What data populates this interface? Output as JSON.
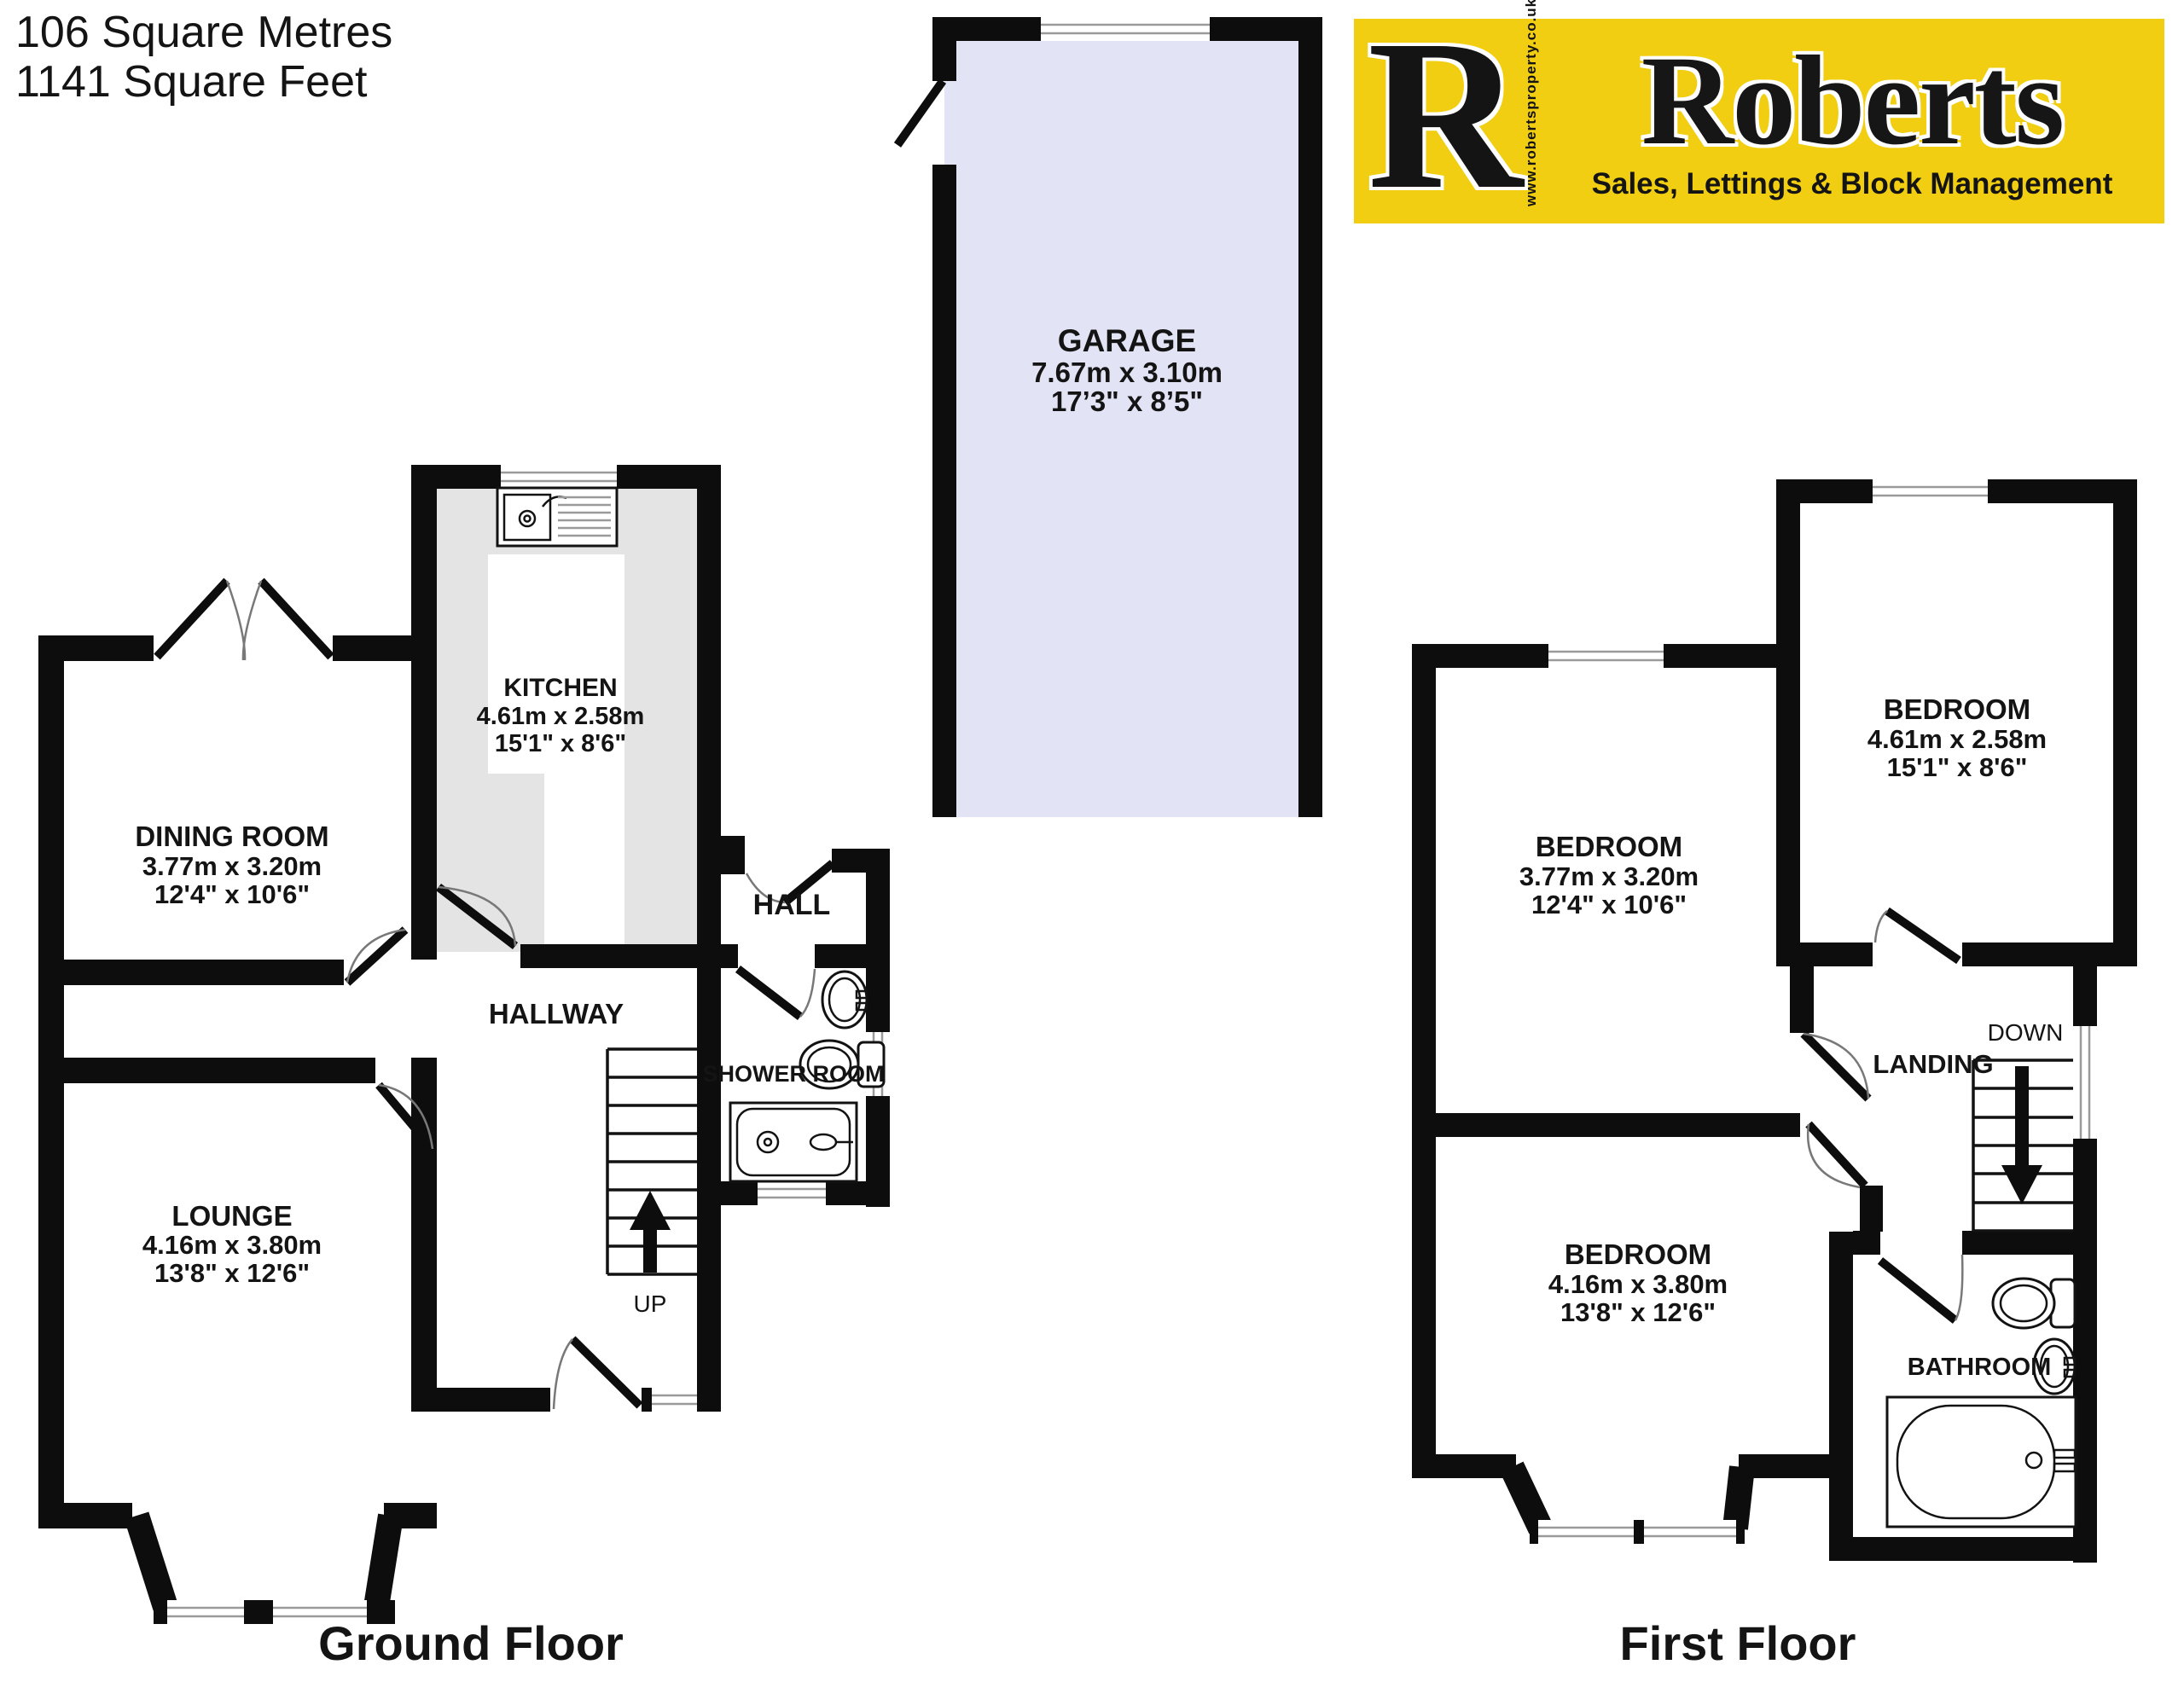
{
  "header": {
    "area_metric": "106 Square Metres",
    "area_imperial": "1141 Square Feet"
  },
  "logo": {
    "letter": "R",
    "website": "www.robertsproperty.co.uk",
    "brand": "Roberts",
    "tagline": "Sales, Lettings & Block Management",
    "bg_color": "#F1CE11"
  },
  "garage": {
    "name": "GARAGE",
    "metric": "7.67m x 3.10m",
    "imperial": "17’3\" x 8’5\"",
    "fill": "#E2E4F5"
  },
  "ground_floor": {
    "label": "Ground Floor",
    "dining": {
      "name": "DINING ROOM",
      "metric": "3.77m  x 3.20m",
      "imperial": "12'4\"  x 10'6\""
    },
    "kitchen": {
      "name": "KITCHEN",
      "metric": "4.61m  x 2.58m",
      "imperial": "15'1\"  x 8'6\"",
      "fill": "#E4E4E4"
    },
    "lounge": {
      "name": "LOUNGE",
      "metric": "4.16m  x 3.80m",
      "imperial": "13'8\"  x 12'6\""
    },
    "hall": "HALL",
    "hallway": "HALLWAY",
    "shower_room": "SHOWER ROOM",
    "stairs_direction": "UP"
  },
  "first_floor": {
    "label": "First Floor",
    "bedroom1": {
      "name": "BEDROOM",
      "metric": "4.61m  x 2.58m",
      "imperial": "15'1\"  x 8'6\""
    },
    "bedroom2": {
      "name": "BEDROOM",
      "metric": "3.77m  x 3.20m",
      "imperial": "12'4\"  x 10'6\""
    },
    "bedroom3": {
      "name": "BEDROOM",
      "metric": "4.16m  x 3.80m",
      "imperial": "13'8\"  x 12'6\""
    },
    "landing": "LANDING",
    "bathroom": "BATHROOM",
    "stairs_direction": "DOWN"
  }
}
